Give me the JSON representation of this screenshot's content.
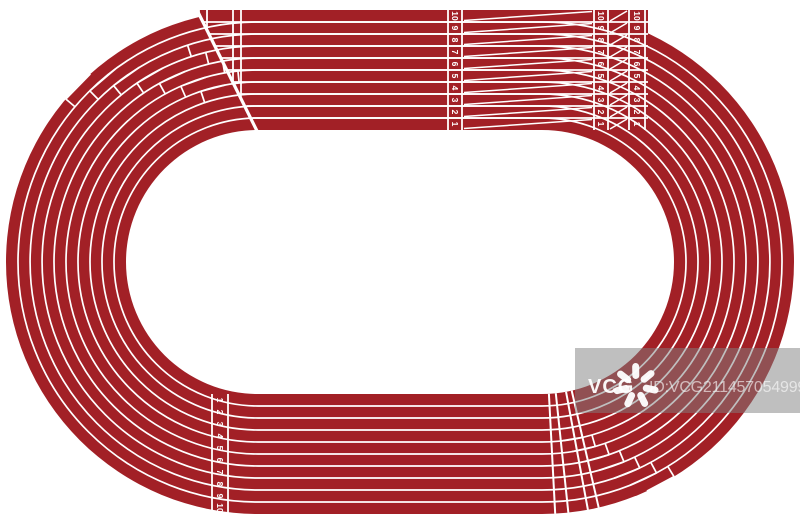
{
  "image": {
    "width": 800,
    "height": 524,
    "background_color": "#ffffff",
    "description": "Top view of a running track stadium illustration"
  },
  "track": {
    "type": "athletics-running-track-top-view",
    "lane_count": 10,
    "lane_numbers": [
      "1",
      "2",
      "3",
      "4",
      "5",
      "6",
      "7",
      "8",
      "9",
      "10"
    ],
    "colors": {
      "surface": "#a22026",
      "lane_line": "#ffffff",
      "infield": "#ffffff"
    },
    "markings": {
      "top_straight_numbered_columns": 3,
      "bottom_straight_numbered_columns": 1,
      "staggered_start_curves": [
        "top-left",
        "bottom-right"
      ],
      "start_chute": "top-left diagonal break"
    }
  },
  "watermark": {
    "brand": "VCG",
    "id_text": "ID:VCG211457054999",
    "band_color": "rgba(128,128,128,0.5)",
    "brand_color": "rgba(255,255,255,0.95)",
    "id_color": "rgba(255,255,255,0.6)"
  }
}
